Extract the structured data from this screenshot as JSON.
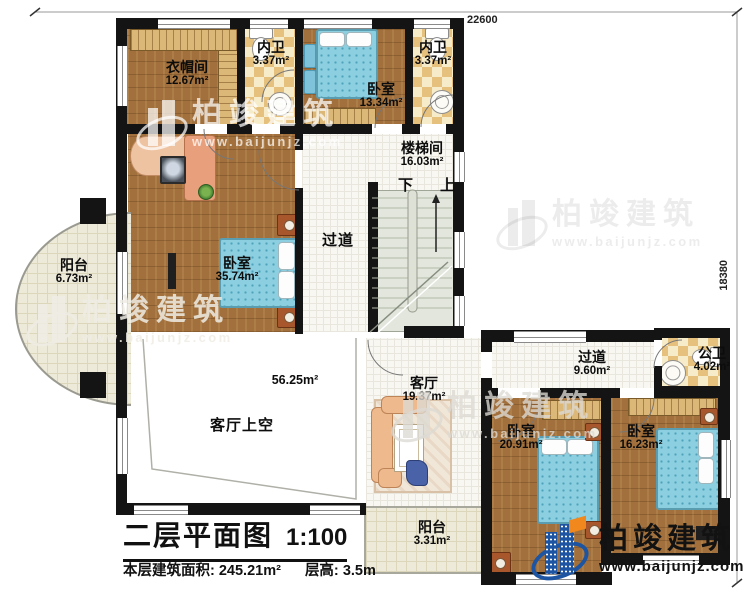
{
  "plan": {
    "title": "二层平面图",
    "scale": "1:100",
    "floor_area_label": "本层建筑面积:",
    "floor_area_value": "245.21m²",
    "floor_height_label": "层高:",
    "floor_height_value": "3.5m"
  },
  "dimensions": {
    "top_width": "22600",
    "right_height": "18380"
  },
  "stairs": {
    "down_label": "下",
    "up_label": "上"
  },
  "rooms": [
    {
      "id": "cloakroom",
      "name": "衣帽间",
      "area": "12.67m²"
    },
    {
      "id": "bath-ensuite-1",
      "name": "内卫",
      "area": "3.37m²"
    },
    {
      "id": "bedroom-top",
      "name": "卧室",
      "area": "13.34m²"
    },
    {
      "id": "bath-ensuite-2",
      "name": "内卫",
      "area": "3.37m²"
    },
    {
      "id": "stairwell",
      "name": "楼梯间",
      "area": "16.03m²"
    },
    {
      "id": "corridor-main",
      "name": "过道",
      "area": ""
    },
    {
      "id": "bedroom-master",
      "name": "卧室",
      "area": "35.74m²"
    },
    {
      "id": "balcony-left",
      "name": "阳台",
      "area": "6.73m²"
    },
    {
      "id": "living-void",
      "name": "客厅上空",
      "area": "56.25m²"
    },
    {
      "id": "living-room",
      "name": "客厅",
      "area": "19.37m²"
    },
    {
      "id": "corridor-right",
      "name": "过道",
      "area": "9.60m²"
    },
    {
      "id": "bath-public",
      "name": "公卫",
      "area": "4.02m²"
    },
    {
      "id": "bedroom-bottom-left",
      "name": "卧室",
      "area": "20.91m²"
    },
    {
      "id": "bedroom-bottom-right",
      "name": "卧室",
      "area": "16.23m²"
    },
    {
      "id": "balcony-bottom",
      "name": "阳台",
      "area": "3.31m²"
    }
  ],
  "watermark": {
    "brand": "柏竣建筑",
    "url": "www.baijunjz.com"
  },
  "logo": {
    "brand": "柏竣建筑",
    "url": "www.baijunjz.com"
  }
}
